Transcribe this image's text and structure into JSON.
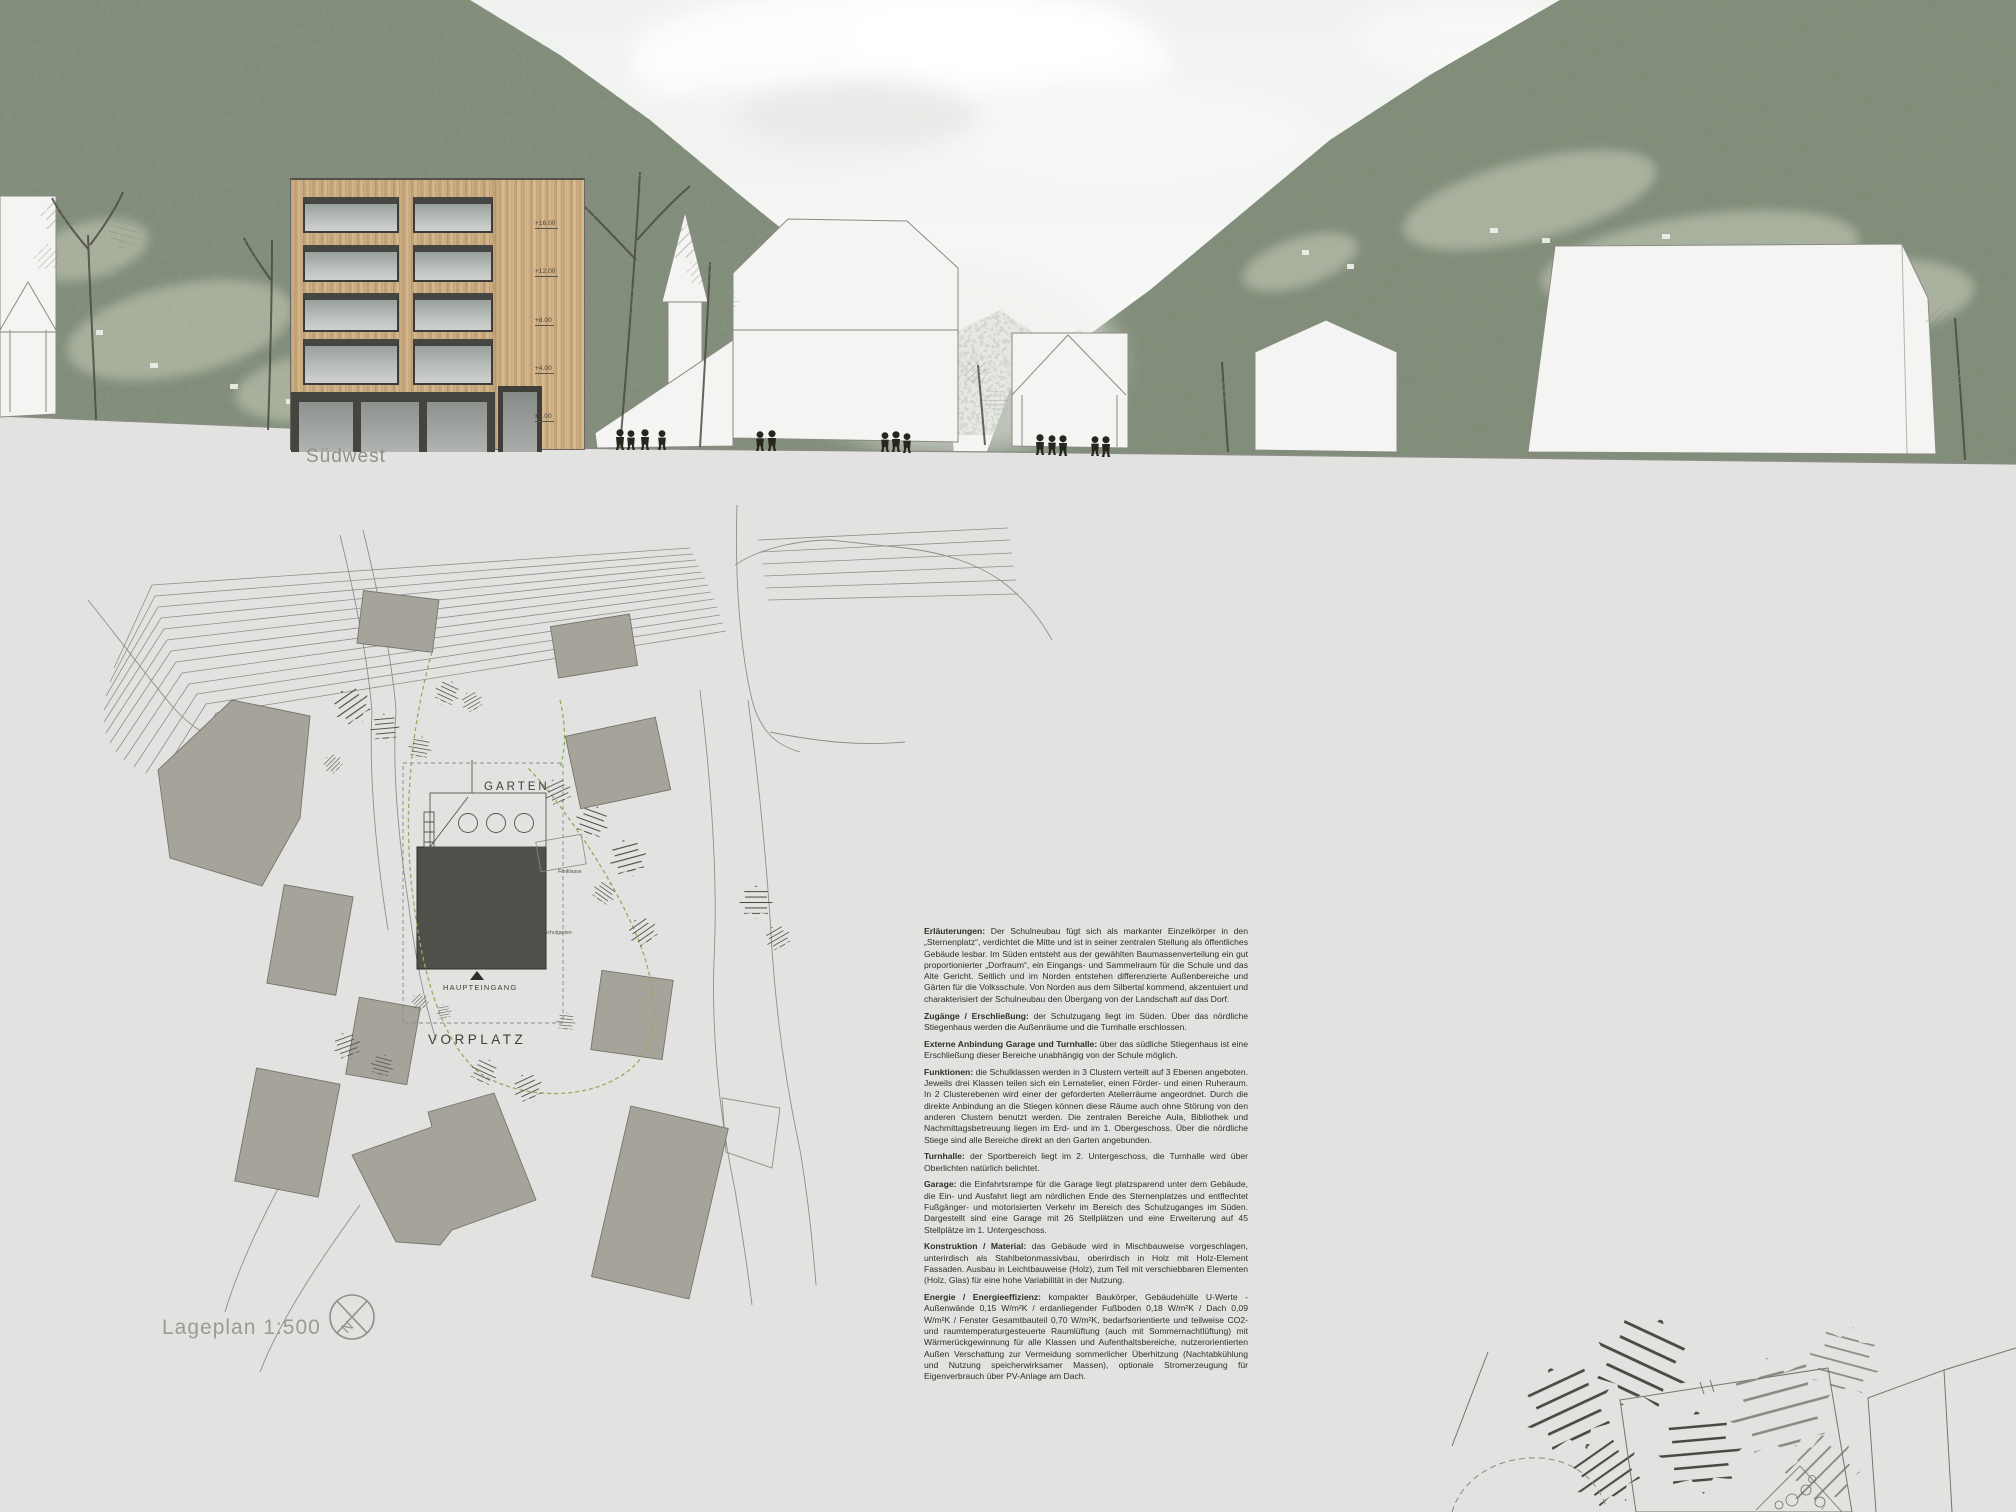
{
  "sheet": {
    "elevation_caption": "Südwest",
    "plan_caption": "Lageplan 1:500",
    "compass_north_label": "N"
  },
  "elevation": {
    "level_markers": [
      "+16.00",
      "+12.00",
      "+8.00",
      "+4.00",
      "±0.00"
    ]
  },
  "site_plan": {
    "labels": {
      "garten": "GARTEN",
      "vorplatz": "VORPLATZ",
      "haupteingang": "HAUPTEINGANG",
      "freiklasse": "Freiklasse",
      "schulgarten": "Schulgarten"
    },
    "scale": "1:500"
  },
  "description": {
    "paragraphs": [
      {
        "title": "Erläuterungen:",
        "body": "Der Schulneubau fügt sich als markanter Einzelkörper in den „Sternenplatz“, verdichtet die Mitte und ist in seiner zentralen Stellung als öffentliches Gebäude lesbar. Im Süden entsteht aus der gewählten Baumassenverteilung ein gut proportionierter „Dorfraum“, ein Eingangs- und Sammelraum für die Schule und das Alte Gericht. Seitlich und im Norden entstehen differenzierte Außenbereiche und Gärten für die Volksschule. Von Norden aus dem Silbertal kommend, akzentuiert und charakterisiert der Schulneubau den Übergang von der Landschaft auf das Dorf."
      },
      {
        "title": "Zugänge / Erschließung:",
        "body": "der Schulzugang liegt im Süden. Über das nördliche Stiegenhaus werden die Außenräume und die Turnhalle erschlossen."
      },
      {
        "title": "Externe Anbindung Garage und Turnhalle:",
        "body": "über das südliche Stiegenhaus ist eine Erschließung dieser Bereiche unabhängig von der Schule möglich."
      },
      {
        "title": "Funktionen:",
        "body": "die Schulklassen werden in 3 Clustern verteilt auf 3 Ebenen angeboten. Jeweils drei Klassen teilen sich ein Lernatelier, einen Förder- und einen Ruheraum. In 2 Clusterebenen wird einer der geforderten Atelierräume angeordnet. Durch die direkte Anbindung an die Stiegen können diese Räume auch ohne Störung von den anderen Clustern benutzt werden. Die zentralen Bereiche Aula, Bibliothek und Nachmittagsbetreuung liegen im Erd- und im 1. Obergeschoss. Über die nördliche Stiege sind alle Bereiche direkt an den Garten angebunden."
      },
      {
        "title": "Turnhalle:",
        "body": "der Sportbereich liegt im 2. Untergeschoss, die Turnhalle wird über Oberlichten natürlich belichtet."
      },
      {
        "title": "Garage:",
        "body": "die Einfahrtsrampe für die Garage liegt platzsparend unter dem Gebäude, die Ein- und Ausfahrt liegt am nördlichen Ende des Sternenplatzes und entflechtet Fußgänger- und motorisierten Verkehr im Bereich des Schulzuganges im Süden. Dargestellt sind eine Garage mit 26 Stellplätzen und eine Erweiterung auf 45 Stellplätze im 1. Untergeschoss."
      },
      {
        "title": "Konstruktion / Material:",
        "body": "das Gebäude wird in Mischbauweise vorgeschlagen, unterirdisch als Stahlbetonmassivbau, oberirdisch in Holz mit Holz-Element Fassaden. Ausbau in Leichtbauweise (Holz), zum Teil mit verschiebbaren Elementen (Holz, Glas) für eine hohe Variabilität in der Nutzung."
      },
      {
        "title": "Energie / Energieeffizienz:",
        "body": "kompakter Baukörper, Gebäudehülle U-Werte - Außenwände 0,15 W/m²K / erdanliegender Fußboden 0,18 W/m²K / Dach 0,09 W/m²K / Fenster Gesamtbauteil 0,70 W/m²K, bedarfsorientierte und teilweise CO2- und raumtemperaturgesteuerte Raumlüftung (auch mit Sommernachtlüftung) mit Wärmerückgewinnung für alle Klassen und Aufenthaltsbereiche, nutzerorientierten Außen Verschattung zur Vermeidung sommerlicher Überhitzung (Nachtabkühlung und Nutzung speicherwirksamer Massen), optionale Stromerzeugung für Eigenverbrauch über PV-Anlage am Dach."
      }
    ]
  },
  "colors": {
    "paper": "#e2e2e0",
    "wood_facade": "#c7a87d",
    "plan_building": "#a6a39b",
    "school_footprint": "#504f4a",
    "boundary_green": "#8fae5f",
    "forest": "#85907b"
  }
}
